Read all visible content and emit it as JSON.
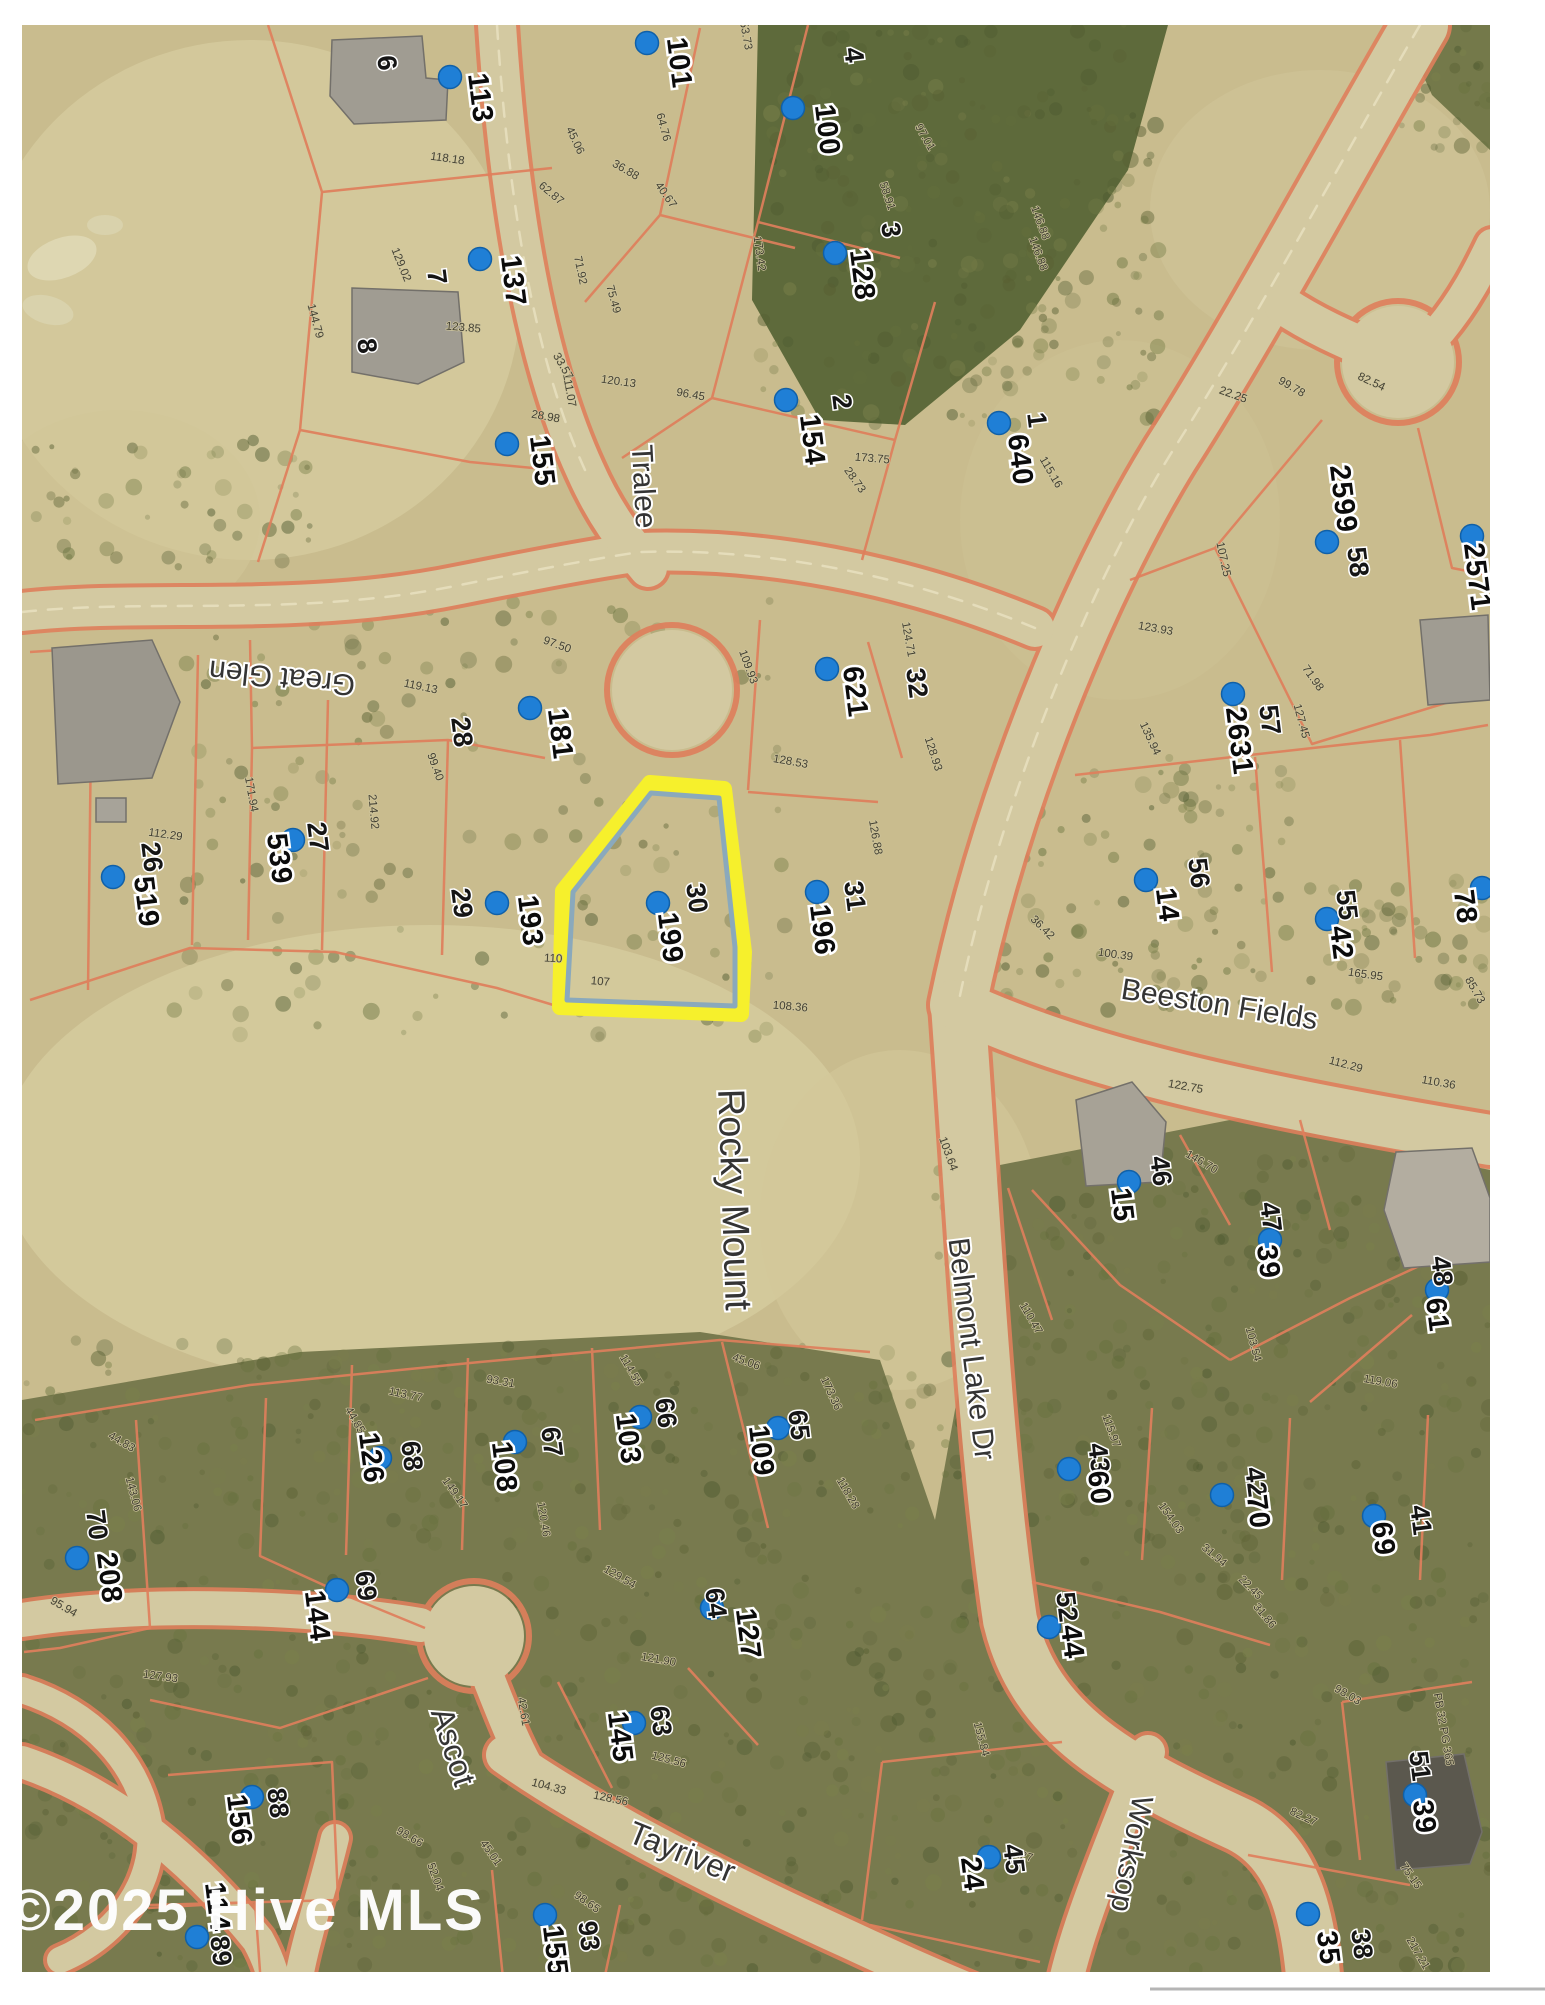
{
  "image_type": "scanned plat / parcel aerial map photo",
  "watermark": "©2025 Hive MLS",
  "plat_reference": "PB 32 PG 365",
  "colors": {
    "map_base": "#c9bc8e",
    "road_fill": "#d3c9a1",
    "parcel_line": "#df7f5c",
    "woods": "#77794d",
    "forest_dark": "#5e6a3b",
    "marker_blue": "#1f7fd6",
    "highlight_outline": "#f6f02c",
    "highlight_inner": "#8aa9bc",
    "watermark_white": "#ffffff"
  },
  "highlighted_parcel": {
    "lot_no": "30",
    "parcel_no": "199"
  },
  "streets": [
    {
      "name": "Tralee",
      "x": 634,
      "y": 487,
      "rot": 87,
      "size": 30
    },
    {
      "name": "Great Glen",
      "x": 283,
      "y": 668,
      "rot": 186,
      "size": 30
    },
    {
      "name": "Beeston Fields",
      "x": 1218,
      "y": 1014,
      "rot": 9,
      "size": 30
    },
    {
      "name": "Belmont Lake Dr",
      "x": 962,
      "y": 1350,
      "rot": 83,
      "size": 30
    },
    {
      "name": "Rocky Mount",
      "x": 722,
      "y": 1200,
      "rot": 88,
      "size": 38
    },
    {
      "name": "Ascot",
      "x": 443,
      "y": 1750,
      "rot": 72,
      "size": 32
    },
    {
      "name": "Tayriver",
      "x": 678,
      "y": 1862,
      "rot": 22,
      "size": 32
    },
    {
      "name": "Worksop",
      "x": 1122,
      "y": 1852,
      "rot": 101,
      "size": 30
    }
  ],
  "parcels": [
    {
      "lot_no": "6",
      "parcel_no": "113",
      "dot": [
        450,
        77
      ],
      "lot_xy": [
        378,
        64
      ],
      "parcel_xy": [
        471,
        99
      ]
    },
    {
      "lot_no": "",
      "parcel_no": "101",
      "dot": [
        647,
        43
      ],
      "parcel_xy": [
        670,
        64
      ]
    },
    {
      "lot_no": "",
      "parcel_no": "100",
      "dot": [
        793,
        108
      ],
      "parcel_xy": [
        818,
        131
      ]
    },
    {
      "lot_no": "4",
      "parcel_no": "",
      "lot_xy": [
        845,
        56
      ]
    },
    {
      "lot_no": "3",
      "parcel_no": "128",
      "dot": [
        835,
        253
      ],
      "lot_xy": [
        882,
        231
      ],
      "parcel_xy": [
        853,
        276
      ]
    },
    {
      "lot_no": "7",
      "parcel_no": "137",
      "dot": [
        480,
        259
      ],
      "lot_xy": [
        428,
        278
      ],
      "parcel_xy": [
        504,
        282
      ]
    },
    {
      "lot_no": "8",
      "parcel_no": "155",
      "dot": [
        507,
        444
      ],
      "lot_xy": [
        358,
        347
      ],
      "parcel_xy": [
        533,
        462
      ]
    },
    {
      "lot_no": "2",
      "parcel_no": "154",
      "dot": [
        786,
        400
      ],
      "lot_xy": [
        833,
        403
      ],
      "parcel_xy": [
        803,
        441
      ]
    },
    {
      "lot_no": "1",
      "parcel_no": "640",
      "dot": [
        999,
        423
      ],
      "lot_xy": [
        1028,
        421
      ],
      "parcel_xy": [
        1011,
        461
      ]
    },
    {
      "lot_no": "58",
      "parcel_no": "2599",
      "dot": [
        1327,
        542
      ],
      "lot_xy": [
        1349,
        563
      ],
      "parcel_xy": [
        1334,
        500
      ]
    },
    {
      "lot_no": "59",
      "parcel_no": "2571",
      "dot": [
        1472,
        536
      ],
      "lot_xy": [
        1497,
        546
      ],
      "parcel_xy": [
        1468,
        578
      ]
    },
    {
      "lot_no": "57",
      "parcel_no": "2631",
      "dot": [
        1233,
        694
      ],
      "lot_xy": [
        1261,
        721
      ],
      "parcel_xy": [
        1230,
        742
      ]
    },
    {
      "lot_no": "28",
      "parcel_no": "181",
      "dot": [
        530,
        708
      ],
      "lot_xy": [
        453,
        733
      ],
      "parcel_xy": [
        551,
        735
      ]
    },
    {
      "lot_no": "26",
      "parcel_no": "519",
      "dot": [
        113,
        877
      ],
      "lot_xy": [
        143,
        858
      ],
      "parcel_xy": [
        137,
        903
      ]
    },
    {
      "lot_no": "27",
      "parcel_no": "539",
      "dot": [
        293,
        840
      ],
      "lot_xy": [
        309,
        838
      ],
      "parcel_xy": [
        270,
        860
      ]
    },
    {
      "lot_no": "29",
      "parcel_no": "193",
      "dot": [
        497,
        903
      ],
      "lot_xy": [
        453,
        904
      ],
      "parcel_xy": [
        521,
        922
      ]
    },
    {
      "lot_no": "30",
      "parcel_no": "199",
      "dot": [
        658,
        903
      ],
      "lot_xy": [
        688,
        899
      ],
      "parcel_xy": [
        661,
        939
      ],
      "highlighted": true
    },
    {
      "lot_no": "31",
      "parcel_no": "196",
      "dot": [
        817,
        892
      ],
      "lot_xy": [
        846,
        897
      ],
      "parcel_xy": [
        813,
        931
      ]
    },
    {
      "lot_no": "32",
      "parcel_no": "621",
      "dot": [
        827,
        669
      ],
      "lot_xy": [
        908,
        684
      ],
      "parcel_xy": [
        846,
        693
      ]
    },
    {
      "lot_no": "56",
      "parcel_no": "14",
      "dot": [
        1146,
        880
      ],
      "lot_xy": [
        1190,
        874
      ],
      "parcel_xy": [
        1158,
        906
      ]
    },
    {
      "lot_no": "55",
      "parcel_no": "42",
      "dot": [
        1327,
        919
      ],
      "lot_xy": [
        1338,
        906
      ],
      "parcel_xy": [
        1332,
        944
      ]
    },
    {
      "lot_no": "",
      "parcel_no": "78",
      "dot": [
        1482,
        888
      ],
      "parcel_xy": [
        1456,
        908
      ]
    },
    {
      "lot_no": "46",
      "parcel_no": "15",
      "dot": [
        1129,
        1182
      ],
      "lot_xy": [
        1152,
        1172
      ],
      "parcel_xy": [
        1113,
        1206
      ]
    },
    {
      "lot_no": "47",
      "parcel_no": "39",
      "dot": [
        1270,
        1240
      ],
      "lot_xy": [
        1262,
        1218
      ],
      "parcel_xy": [
        1259,
        1263
      ]
    },
    {
      "lot_no": "48",
      "parcel_no": "61",
      "dot": [
        1437,
        1290
      ],
      "lot_xy": [
        1433,
        1272
      ],
      "parcel_xy": [
        1428,
        1316
      ]
    },
    {
      "lot_no": "70",
      "parcel_no": "208",
      "dot": [
        77,
        1558
      ],
      "lot_xy": [
        88,
        1526
      ],
      "parcel_xy": [
        100,
        1579
      ]
    },
    {
      "lot_no": "68",
      "parcel_no": "126",
      "dot": [
        380,
        1458
      ],
      "lot_xy": [
        403,
        1457
      ],
      "parcel_xy": [
        362,
        1459
      ]
    },
    {
      "lot_no": "67",
      "parcel_no": "108",
      "dot": [
        515,
        1442
      ],
      "lot_xy": [
        543,
        1443
      ],
      "parcel_xy": [
        495,
        1468
      ]
    },
    {
      "lot_no": "66",
      "parcel_no": "103",
      "dot": [
        640,
        1417
      ],
      "lot_xy": [
        657,
        1414
      ],
      "parcel_xy": [
        619,
        1440
      ]
    },
    {
      "lot_no": "65",
      "parcel_no": "109",
      "dot": [
        778,
        1428
      ],
      "lot_xy": [
        790,
        1426
      ],
      "parcel_xy": [
        752,
        1452
      ]
    },
    {
      "lot_no": "69",
      "parcel_no": "144",
      "dot": [
        337,
        1590
      ],
      "lot_xy": [
        357,
        1587
      ],
      "parcel_xy": [
        308,
        1617
      ]
    },
    {
      "lot_no": "64",
      "parcel_no": "127",
      "dot": [
        712,
        1608
      ],
      "lot_xy": [
        707,
        1604
      ],
      "parcel_xy": [
        739,
        1635
      ]
    },
    {
      "lot_no": "63",
      "parcel_no": "145",
      "dot": [
        634,
        1723
      ],
      "lot_xy": [
        652,
        1722
      ],
      "parcel_xy": [
        611,
        1738
      ]
    },
    {
      "lot_no": "43",
      "parcel_no": "60",
      "dot": [
        1069,
        1469
      ],
      "lot_xy": [
        1090,
        1459
      ],
      "parcel_xy": [
        1090,
        1489
      ]
    },
    {
      "lot_no": "42",
      "parcel_no": "70",
      "dot": [
        1222,
        1495
      ],
      "lot_xy": [
        1247,
        1483
      ],
      "parcel_xy": [
        1249,
        1513
      ]
    },
    {
      "lot_no": "41",
      "parcel_no": "69",
      "dot": [
        1374,
        1516
      ],
      "lot_xy": [
        1412,
        1521
      ],
      "parcel_xy": [
        1374,
        1540
      ]
    },
    {
      "lot_no": "52",
      "parcel_no": "44",
      "dot": [
        1049,
        1627
      ],
      "lot_xy": [
        1058,
        1608
      ],
      "parcel_xy": [
        1063,
        1643
      ]
    },
    {
      "lot_no": "51",
      "parcel_no": "39",
      "dot": [
        1415,
        1795
      ],
      "lot_xy": [
        1411,
        1767
      ],
      "parcel_xy": [
        1415,
        1818
      ]
    },
    {
      "lot_no": "45",
      "parcel_no": "24",
      "dot": [
        989,
        1857
      ],
      "lot_xy": [
        1005,
        1860
      ],
      "parcel_xy": [
        963,
        1875
      ]
    },
    {
      "lot_no": "38",
      "parcel_no": "35",
      "dot": [
        1308,
        1914
      ],
      "lot_xy": [
        1353,
        1945
      ],
      "parcel_xy": [
        1319,
        1949
      ]
    },
    {
      "lot_no": "93",
      "parcel_no": "155",
      "dot": [
        545,
        1915
      ],
      "lot_xy": [
        580,
        1937
      ],
      "parcel_xy": [
        546,
        1952
      ]
    },
    {
      "lot_no": "88",
      "parcel_no": "156",
      "dot": [
        252,
        1797
      ],
      "lot_xy": [
        269,
        1804
      ],
      "parcel_xy": [
        230,
        1821
      ]
    },
    {
      "lot_no": "89",
      "parcel_no": "114",
      "dot": [
        197,
        1937
      ],
      "lot_xy": [
        212,
        1952
      ],
      "parcel_xy": [
        208,
        1908
      ]
    }
  ],
  "dimensions": [
    {
      "t": "153.73",
      "x": 742,
      "y": 33,
      "r": 80
    },
    {
      "t": "64.76",
      "x": 660,
      "y": 128,
      "r": 75
    },
    {
      "t": "36.88",
      "x": 624,
      "y": 173,
      "r": 30
    },
    {
      "t": "40.67",
      "x": 663,
      "y": 197,
      "r": 55
    },
    {
      "t": "45.06",
      "x": 572,
      "y": 142,
      "r": 65
    },
    {
      "t": "118.18",
      "x": 447,
      "y": 162,
      "r": 8
    },
    {
      "t": "62.87",
      "x": 549,
      "y": 196,
      "r": 40
    },
    {
      "t": "129.02",
      "x": 398,
      "y": 266,
      "r": 68
    },
    {
      "t": "123.85",
      "x": 463,
      "y": 331,
      "r": 5
    },
    {
      "t": "144.79",
      "x": 312,
      "y": 322,
      "r": 75
    },
    {
      "t": "111.07",
      "x": 566,
      "y": 391,
      "r": 80
    },
    {
      "t": "71.92",
      "x": 577,
      "y": 271,
      "r": 78
    },
    {
      "t": "33.57",
      "x": 560,
      "y": 368,
      "r": 60
    },
    {
      "t": "28.98",
      "x": 545,
      "y": 420,
      "r": 10
    },
    {
      "t": "173.42",
      "x": 756,
      "y": 254,
      "r": 82
    },
    {
      "t": "58.91",
      "x": 884,
      "y": 197,
      "r": 72
    },
    {
      "t": "97.01",
      "x": 922,
      "y": 139,
      "r": 60
    },
    {
      "t": "146.88",
      "x": 1037,
      "y": 224,
      "r": 70
    },
    {
      "t": "173.75",
      "x": 872,
      "y": 462,
      "r": 5
    },
    {
      "t": "28.73",
      "x": 852,
      "y": 482,
      "r": 55
    },
    {
      "t": "115.16",
      "x": 1048,
      "y": 474,
      "r": 60
    },
    {
      "t": "107.25",
      "x": 1220,
      "y": 560,
      "r": 78
    },
    {
      "t": "22.25",
      "x": 1232,
      "y": 398,
      "r": 20
    },
    {
      "t": "99.78",
      "x": 1290,
      "y": 390,
      "r": 30
    },
    {
      "t": "82.54",
      "x": 1370,
      "y": 385,
      "r": 25
    },
    {
      "t": "123.93",
      "x": 1155,
      "y": 632,
      "r": 10
    },
    {
      "t": "135.94",
      "x": 1147,
      "y": 740,
      "r": 65
    },
    {
      "t": "71.98",
      "x": 1310,
      "y": 680,
      "r": 55
    },
    {
      "t": "127.45",
      "x": 1298,
      "y": 722,
      "r": 75
    },
    {
      "t": "100.39",
      "x": 1115,
      "y": 958,
      "r": 8
    },
    {
      "t": "36.42",
      "x": 1040,
      "y": 930,
      "r": 45
    },
    {
      "t": "165.95",
      "x": 1365,
      "y": 978,
      "r": 8
    },
    {
      "t": "85.73",
      "x": 1472,
      "y": 992,
      "r": 60
    },
    {
      "t": "122.75",
      "x": 1185,
      "y": 1090,
      "r": 10
    },
    {
      "t": "112.29",
      "x": 1345,
      "y": 1068,
      "r": 15
    },
    {
      "t": "110.36",
      "x": 1438,
      "y": 1086,
      "r": 10
    },
    {
      "t": "146.70",
      "x": 1200,
      "y": 1165,
      "r": 30
    },
    {
      "t": "103.54",
      "x": 1250,
      "y": 1345,
      "r": 75
    },
    {
      "t": "119.06",
      "x": 1380,
      "y": 1385,
      "r": 10
    },
    {
      "t": "128.53",
      "x": 790,
      "y": 765,
      "r": 10
    },
    {
      "t": "126.88",
      "x": 872,
      "y": 838,
      "r": 80
    },
    {
      "t": "108.36",
      "x": 790,
      "y": 1010,
      "r": 5
    },
    {
      "t": "107",
      "x": 600,
      "y": 985,
      "r": 5
    },
    {
      "t": "110",
      "x": 553,
      "y": 962,
      "r": 3
    },
    {
      "t": "112.29",
      "x": 165,
      "y": 838,
      "r": 8
    },
    {
      "t": "171.94",
      "x": 248,
      "y": 795,
      "r": 80
    },
    {
      "t": "214.92",
      "x": 370,
      "y": 812,
      "r": 85
    },
    {
      "t": "99.40",
      "x": 432,
      "y": 768,
      "r": 70
    },
    {
      "t": "119.13",
      "x": 420,
      "y": 690,
      "r": 12
    },
    {
      "t": "97.50",
      "x": 556,
      "y": 648,
      "r": 20
    },
    {
      "t": "109.93",
      "x": 745,
      "y": 668,
      "r": 70
    },
    {
      "t": "124.71",
      "x": 905,
      "y": 640,
      "r": 80
    },
    {
      "t": "128.93",
      "x": 930,
      "y": 755,
      "r": 72
    },
    {
      "t": "103.64",
      "x": 945,
      "y": 1155,
      "r": 70
    },
    {
      "t": "113.77",
      "x": 405,
      "y": 1398,
      "r": 12
    },
    {
      "t": "44.85",
      "x": 352,
      "y": 1422,
      "r": 60
    },
    {
      "t": "149.17",
      "x": 452,
      "y": 1495,
      "r": 55
    },
    {
      "t": "120.46",
      "x": 540,
      "y": 1520,
      "r": 80
    },
    {
      "t": "93.31",
      "x": 500,
      "y": 1385,
      "r": 10
    },
    {
      "t": "114.55",
      "x": 628,
      "y": 1372,
      "r": 60
    },
    {
      "t": "45.06",
      "x": 745,
      "y": 1365,
      "r": 20
    },
    {
      "t": "173.36",
      "x": 828,
      "y": 1395,
      "r": 65
    },
    {
      "t": "118.28",
      "x": 845,
      "y": 1495,
      "r": 60
    },
    {
      "t": "129.54",
      "x": 618,
      "y": 1580,
      "r": 30
    },
    {
      "t": "121.90",
      "x": 658,
      "y": 1663,
      "r": 10
    },
    {
      "t": "125.56",
      "x": 668,
      "y": 1763,
      "r": 15
    },
    {
      "t": "45.01",
      "x": 488,
      "y": 1855,
      "r": 55
    },
    {
      "t": "42.61",
      "x": 520,
      "y": 1712,
      "r": 80
    },
    {
      "t": "104.33",
      "x": 548,
      "y": 1790,
      "r": 15
    },
    {
      "t": "52.04",
      "x": 432,
      "y": 1878,
      "r": 70
    },
    {
      "t": "98.66",
      "x": 408,
      "y": 1840,
      "r": 30
    },
    {
      "t": "143.06",
      "x": 130,
      "y": 1495,
      "r": 75
    },
    {
      "t": "44.83",
      "x": 120,
      "y": 1445,
      "r": 30
    },
    {
      "t": "95.94",
      "x": 62,
      "y": 1610,
      "r": 30
    },
    {
      "t": "127.93",
      "x": 160,
      "y": 1680,
      "r": 8
    },
    {
      "t": "98.65",
      "x": 585,
      "y": 1905,
      "r": 35
    },
    {
      "t": "128.56",
      "x": 610,
      "y": 1802,
      "r": 12
    },
    {
      "t": "155.84",
      "x": 978,
      "y": 1740,
      "r": 75
    },
    {
      "t": "62.27",
      "x": 1018,
      "y": 1858,
      "r": 15
    },
    {
      "t": "75.15",
      "x": 1408,
      "y": 1878,
      "r": 55
    },
    {
      "t": "82.27",
      "x": 1302,
      "y": 1820,
      "r": 25
    },
    {
      "t": "115.97",
      "x": 1108,
      "y": 1432,
      "r": 70
    },
    {
      "t": "110.47",
      "x": 1028,
      "y": 1320,
      "r": 60
    },
    {
      "t": "154.03",
      "x": 1168,
      "y": 1520,
      "r": 55
    },
    {
      "t": "31.94",
      "x": 1212,
      "y": 1558,
      "r": 40
    },
    {
      "t": "22.45",
      "x": 1248,
      "y": 1590,
      "r": 45
    },
    {
      "t": "31.86",
      "x": 1262,
      "y": 1618,
      "r": 50
    },
    {
      "t": "98.03",
      "x": 1346,
      "y": 1698,
      "r": 30
    },
    {
      "t": "217.21",
      "x": 1415,
      "y": 1955,
      "r": 60
    },
    {
      "t": "134.27",
      "x": 1332,
      "y": 1985,
      "r": 10
    },
    {
      "t": "PB 32 PG 365",
      "x": 1440,
      "y": 1730,
      "r": 80
    },
    {
      "t": "120.13",
      "x": 618,
      "y": 385,
      "r": 8
    },
    {
      "t": "96.45",
      "x": 690,
      "y": 398,
      "r": 10
    },
    {
      "t": "75.49",
      "x": 610,
      "y": 300,
      "r": 75
    },
    {
      "t": "146.88",
      "x": 1035,
      "y": 255,
      "r": 70
    }
  ]
}
